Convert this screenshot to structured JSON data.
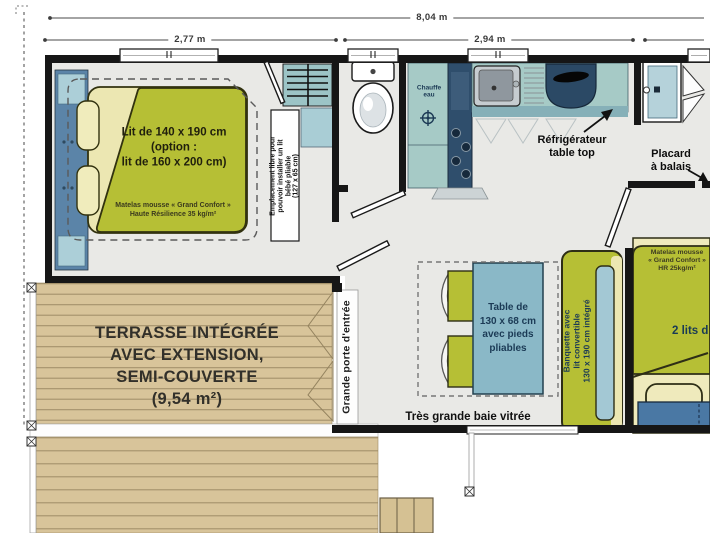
{
  "plan": {
    "dimensions": {
      "total": "8,04 m",
      "section_left": "2,77 m",
      "section_middle": "2,94 m"
    },
    "master_bedroom": {
      "bed_label": [
        "Lit de 140 x 190 cm",
        "(option :",
        "lit de 160 x 200 cm)"
      ],
      "mattress_note": [
        "Matelas mousse « Grand Confort »",
        "Haute Résilience 35 kg/m²"
      ],
      "baby_bed_note": [
        "Emplacement libre pour",
        "pouvoir installer un lit",
        "bébé pliable",
        "(127 x 65 cm)"
      ]
    },
    "bathroom_kitchen": {
      "water_heater": [
        "Chauffe",
        "eau"
      ],
      "fridge": [
        "Réfrigérateur",
        "table top"
      ],
      "broom_closet": [
        "Placard",
        "à balais"
      ]
    },
    "living": {
      "table": [
        "Table de",
        "130 x 68 cm",
        "avec pieds",
        "pliables"
      ],
      "bay_window": "Très grande baie vitrée",
      "entrance_door": "Grande porte d'entrée"
    },
    "terrace": {
      "label": [
        "TERRASSE INTÉGRÉE",
        "AVEC EXTENSION,",
        "SEMI-COUVERTE",
        "(9,54 m²)"
      ]
    },
    "second_bedroom": {
      "bench": [
        "Banquette avec",
        "lit convertible",
        "130 x 190 cm intégré"
      ],
      "mattress_note": [
        "Matelas mousse",
        "« Grand Confort »",
        "HR 25kg/m²"
      ],
      "twin_beds": "2 lits d"
    },
    "colors": {
      "wall": "#161616",
      "floor": "#e9e9e6",
      "wood": "#d8c49a",
      "mattress_green": "#b6bf35",
      "pillow_cream": "#efeab8",
      "headboard_blue": "#5b84a8",
      "counter_teal": "#a6cac6",
      "appliance_navy": "#2e4d6b",
      "table_blue": "#8ab8c7",
      "accent_text_navy": "#1c3a55"
    }
  }
}
